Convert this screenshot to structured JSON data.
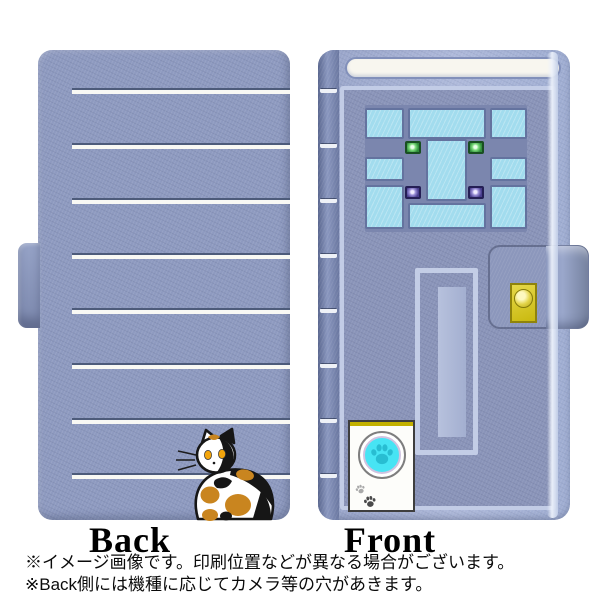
{
  "page": {
    "back_label": "Back",
    "front_label": "Front",
    "notes": [
      "※イメージ画像です。印刷位置などが異なる場合がございます。",
      "※Back側には機種に応じてカメラ等の穴があきます。"
    ]
  },
  "design": {
    "case-color": "#8e9ac0",
    "frame-color": "#aab7d9",
    "door-color": "#8a94b9",
    "stripe-white": "#f8f8f4",
    "stripe-dark": "#4d5b7a",
    "transom-color": "#f8f6ef",
    "window-bg": "#7b86ae",
    "pane-color": "#a2dcee",
    "pane-border": "#64739f",
    "green-light": "#2e8c3a",
    "purple-light": "#473c8c",
    "lock-yellow": "#d6c51e",
    "intercom-cyan": "#47e4f4",
    "paw-teal": "#28bdd2",
    "cat-orange": "#c9851f"
  },
  "icons": {
    "cat": "calico-cat-illustration",
    "paw": "paw-print-icon",
    "lock": "doorknob-lock-icon",
    "windows": "door-window-panes",
    "intercom": "paw-intercom-panel"
  }
}
